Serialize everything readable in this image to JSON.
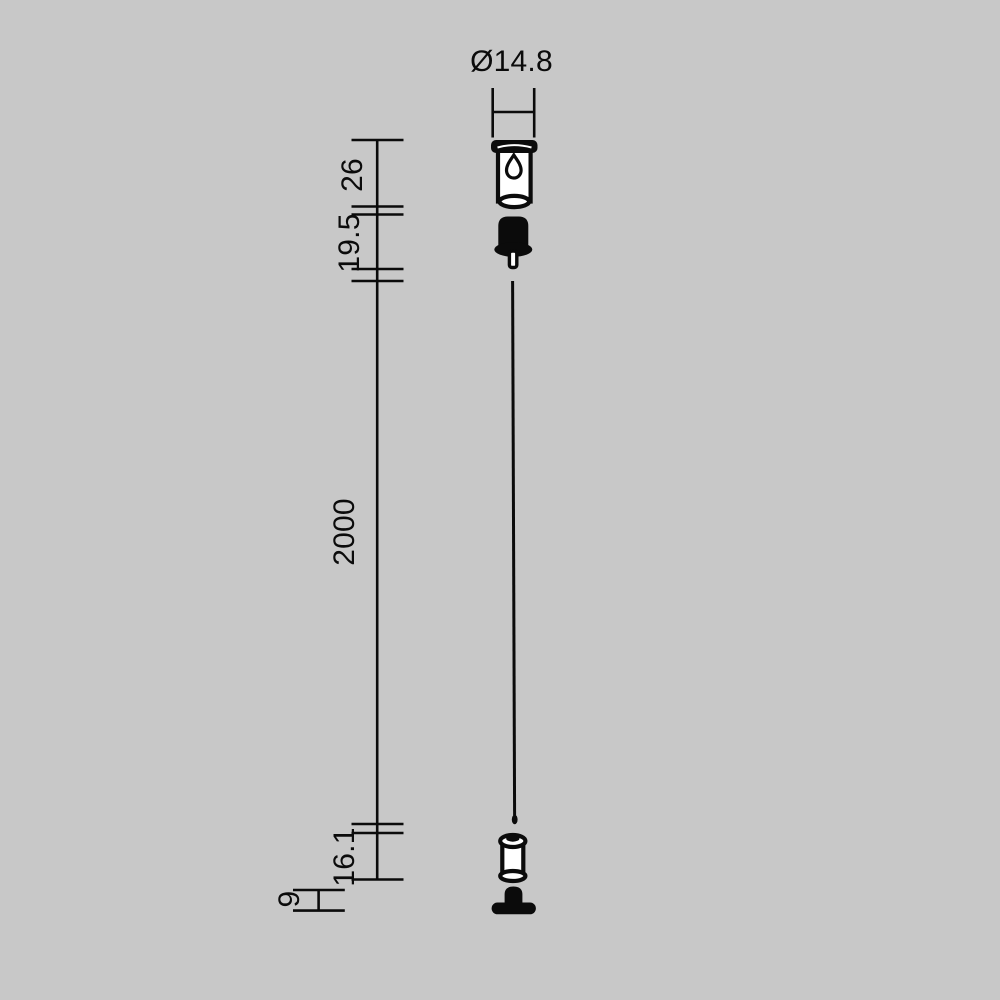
{
  "page": {
    "colors": {
      "background": "#c8c8c8",
      "ink": "#0b0b0b",
      "fill_white": "#ffffff"
    }
  },
  "drawing": {
    "kind": "technical-dimension-drawing",
    "dims": {
      "diameter": "Ø14.8",
      "cup": "26",
      "gripper": "19.5",
      "cable": "2000",
      "adjuster": "16.1",
      "base": "9"
    },
    "parts": [
      "ceiling-canopy",
      "cable-gripper",
      "steel-cable",
      "height-adjuster",
      "track-fixing-base"
    ]
  }
}
